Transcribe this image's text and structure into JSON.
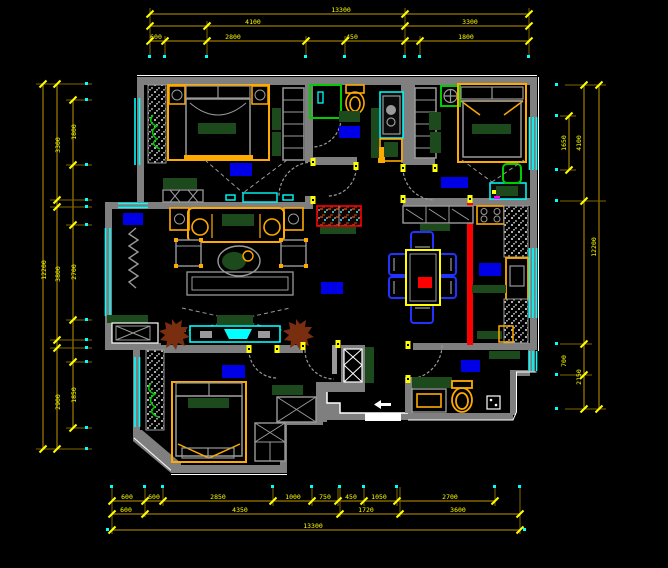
{
  "drawing": {
    "type": "cad-floor-plan",
    "background": "#000000",
    "description": "Apartment furniture floor plan with dimension chains on all four sides"
  },
  "colors": {
    "wall": "#7f7f7f",
    "furniture_gray": "#9a9a9a",
    "dim_line": "#7f6600",
    "dim_text": "#ffff00",
    "window": "#00ffff",
    "furniture_orange": "#ffaa00",
    "room_label_blue": "#0000e6",
    "chair_blue": "#2233ff",
    "accent_red": "#ff0000",
    "soft_green": "#1d4a1d",
    "door_green": "#00cc00",
    "plant_brown": "#7a2e10"
  },
  "dimensions": {
    "top": {
      "overall": "13300",
      "row2": [
        "4100",
        "3300"
      ],
      "row3": [
        "600",
        "2800",
        "450",
        "1800"
      ]
    },
    "bottom": {
      "chain": [
        "600",
        "600",
        "2850",
        "1000",
        "750",
        "450",
        "1050",
        "2700"
      ],
      "mid": [
        "600",
        "4350",
        "1720",
        "3600"
      ],
      "overall": "13300"
    },
    "left": {
      "overall": "12200",
      "mid": [
        "3300",
        "3800",
        "2900"
      ],
      "chain": [
        "1800",
        "2700",
        "1850"
      ]
    },
    "right": {
      "chain": [
        "1650"
      ],
      "mid": [
        "4100",
        "700",
        "2150"
      ],
      "overall": "12200"
    }
  },
  "rooms": [
    {
      "id": "bedroom-top-left"
    },
    {
      "id": "bathroom-top"
    },
    {
      "id": "bedroom-top-right"
    },
    {
      "id": "hallway"
    },
    {
      "id": "kitchen"
    },
    {
      "id": "dining-area"
    },
    {
      "id": "living-room"
    },
    {
      "id": "bedroom-bottom-left"
    },
    {
      "id": "bathroom-bottom-right"
    },
    {
      "id": "shaft"
    }
  ]
}
